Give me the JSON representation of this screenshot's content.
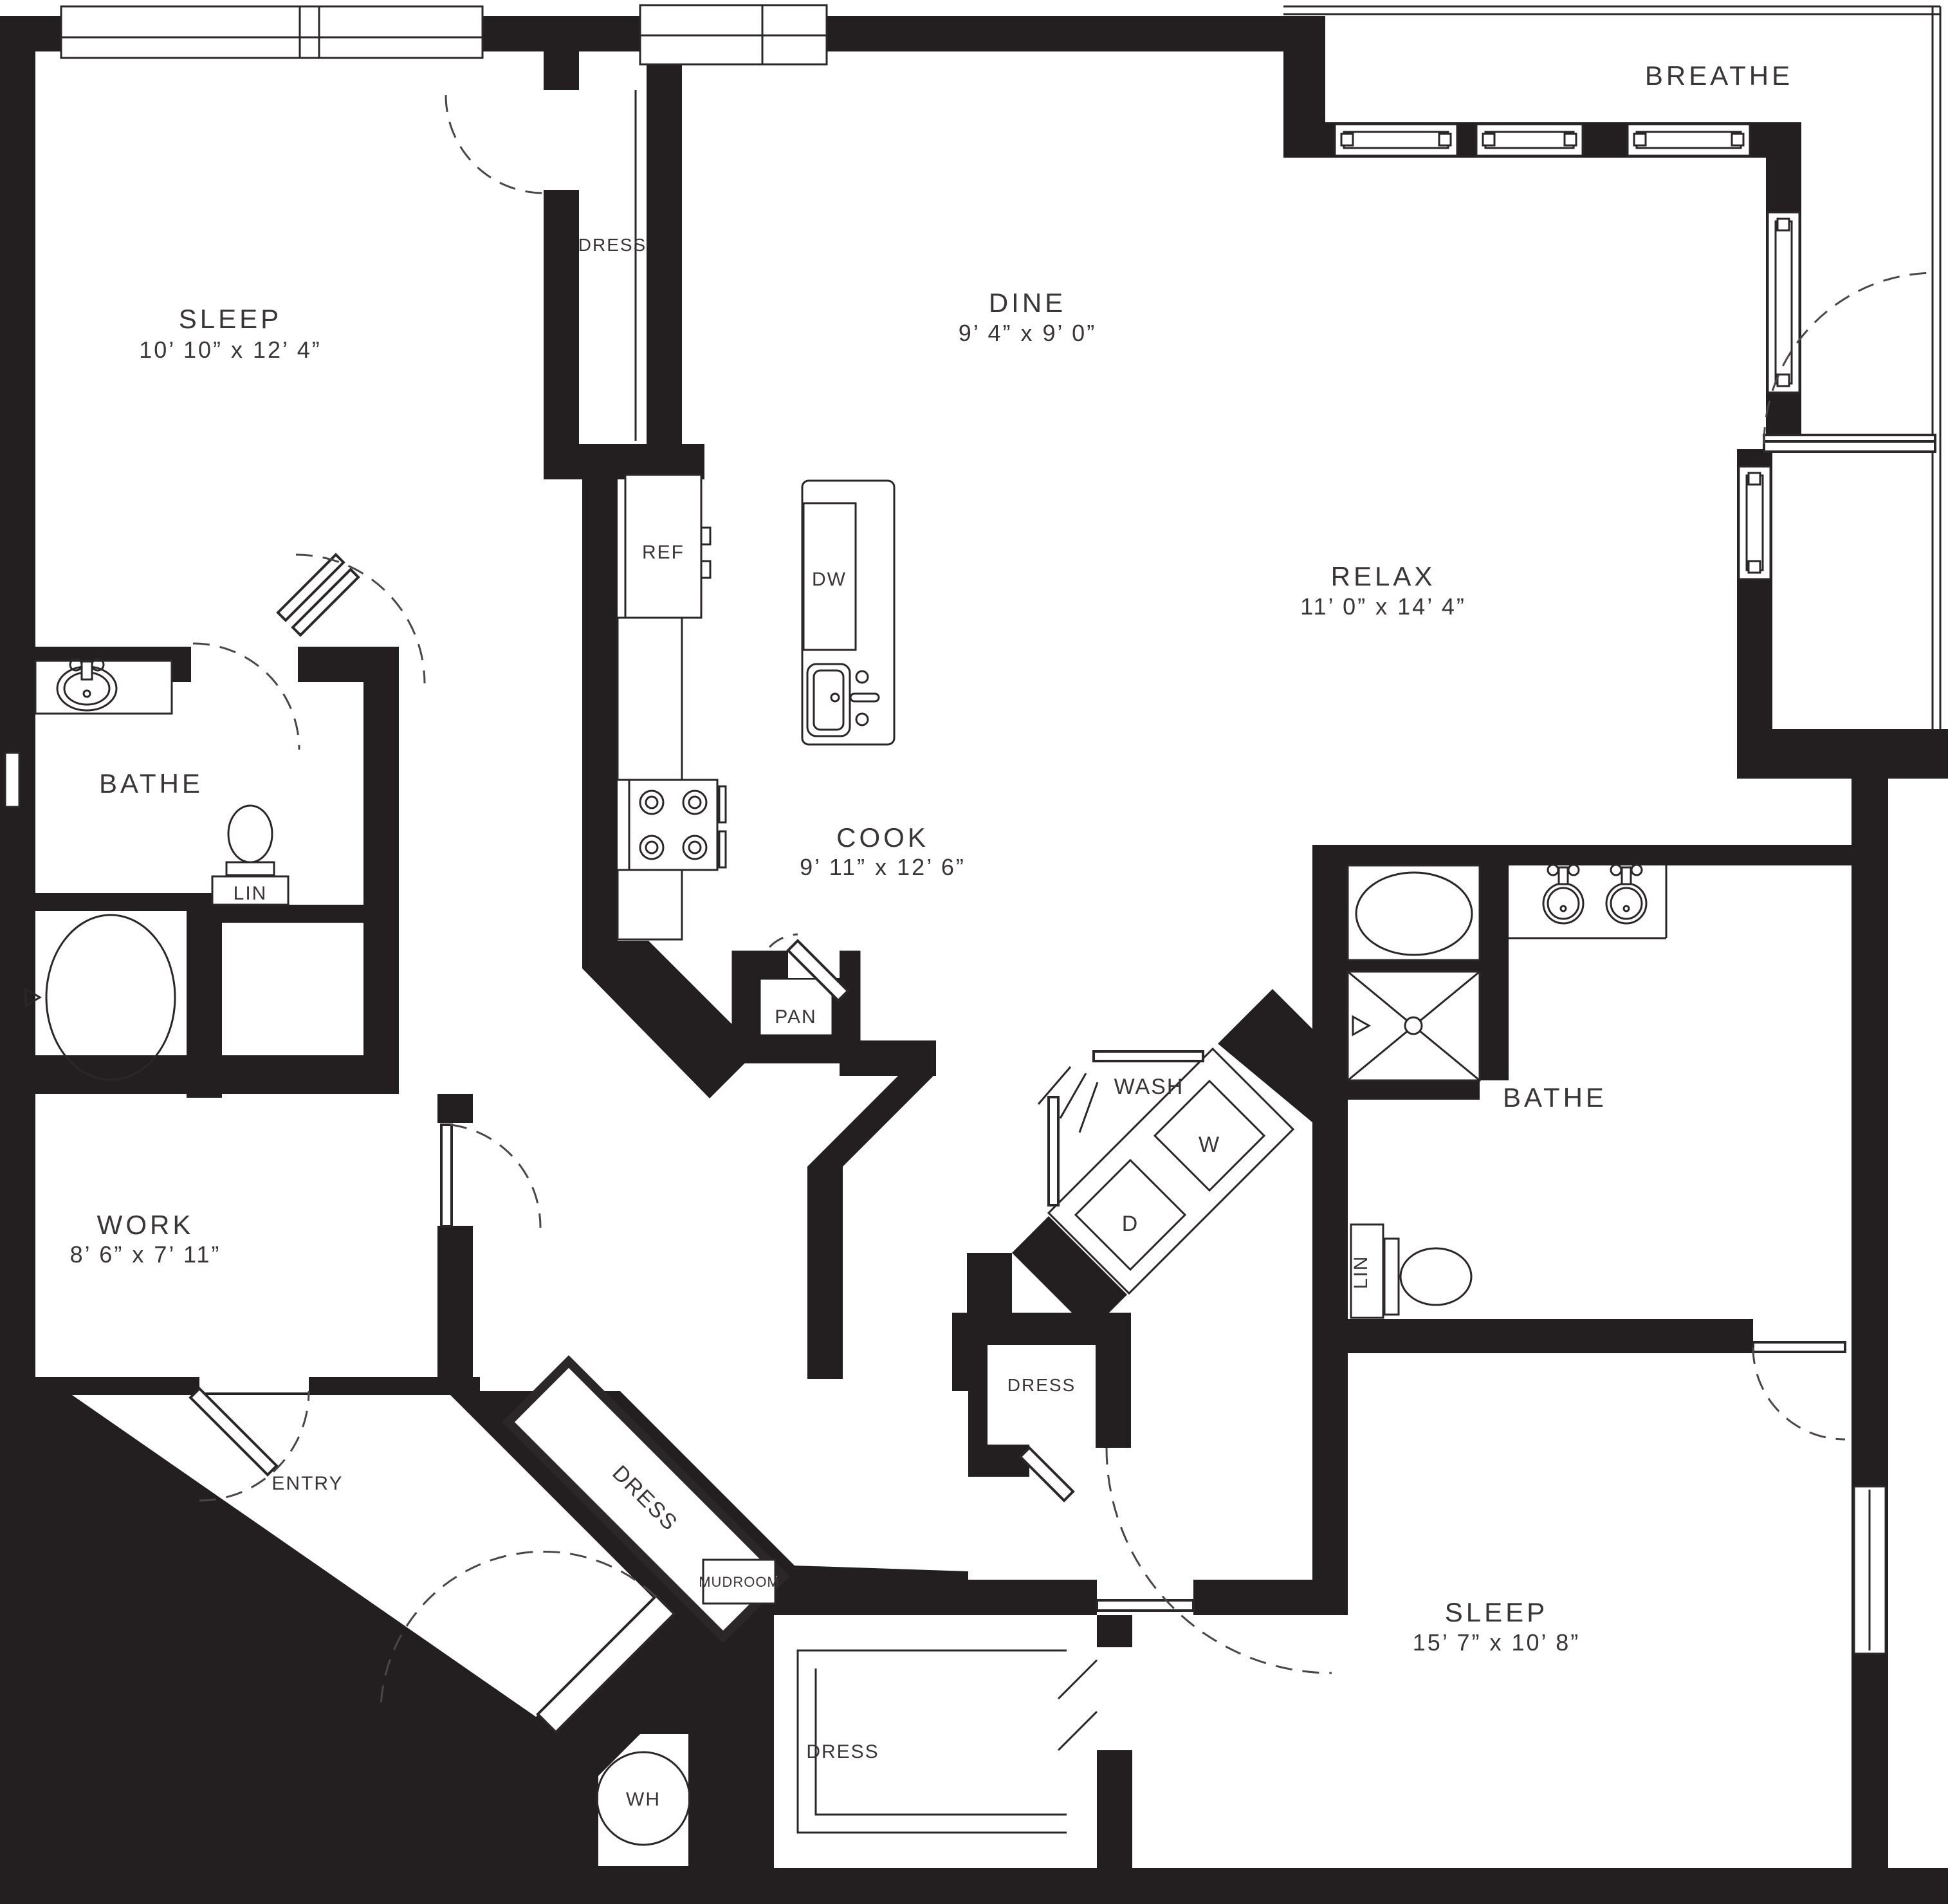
{
  "colors": {
    "wall": "#231f20",
    "line": "#2b2627",
    "label": "#3a3537",
    "background": "#ffffff"
  },
  "rooms": {
    "sleep1": {
      "label": "SLEEP",
      "dims": "10’ 10” x 12’ 4”"
    },
    "dine": {
      "label": "DINE",
      "dims": "9’ 4” x 9’ 0”"
    },
    "relax": {
      "label": "RELAX",
      "dims": "11’ 0” x 14’ 4”"
    },
    "cook": {
      "label": "COOK",
      "dims": "9’ 11” x 12’ 6”"
    },
    "work": {
      "label": "WORK",
      "dims": "8’ 6” x 7’ 11”"
    },
    "sleep2": {
      "label": "SLEEP",
      "dims": "15’ 7” x 10’ 8”"
    },
    "bathe1": {
      "label": "BATHE"
    },
    "bathe2": {
      "label": "BATHE"
    },
    "breathe": {
      "label": "BREATHE"
    },
    "entry": {
      "label": "ENTRY"
    },
    "mudroom": {
      "label": "MUDROOM"
    },
    "wash": {
      "label": "WASH"
    },
    "pan": {
      "label": "PAN"
    },
    "dress_top": {
      "label": "DRESS"
    },
    "dress_hall": {
      "label": "DRESS"
    },
    "dress_diag": {
      "label": "DRESS"
    },
    "dress_walkin": {
      "label": "DRESS"
    }
  },
  "fixtures": {
    "refrigerator": "REF",
    "dishwasher": "DW",
    "washer": "W",
    "dryer": "D",
    "water_heater": "WH",
    "linen1": "LIN",
    "linen2": "LIN"
  }
}
